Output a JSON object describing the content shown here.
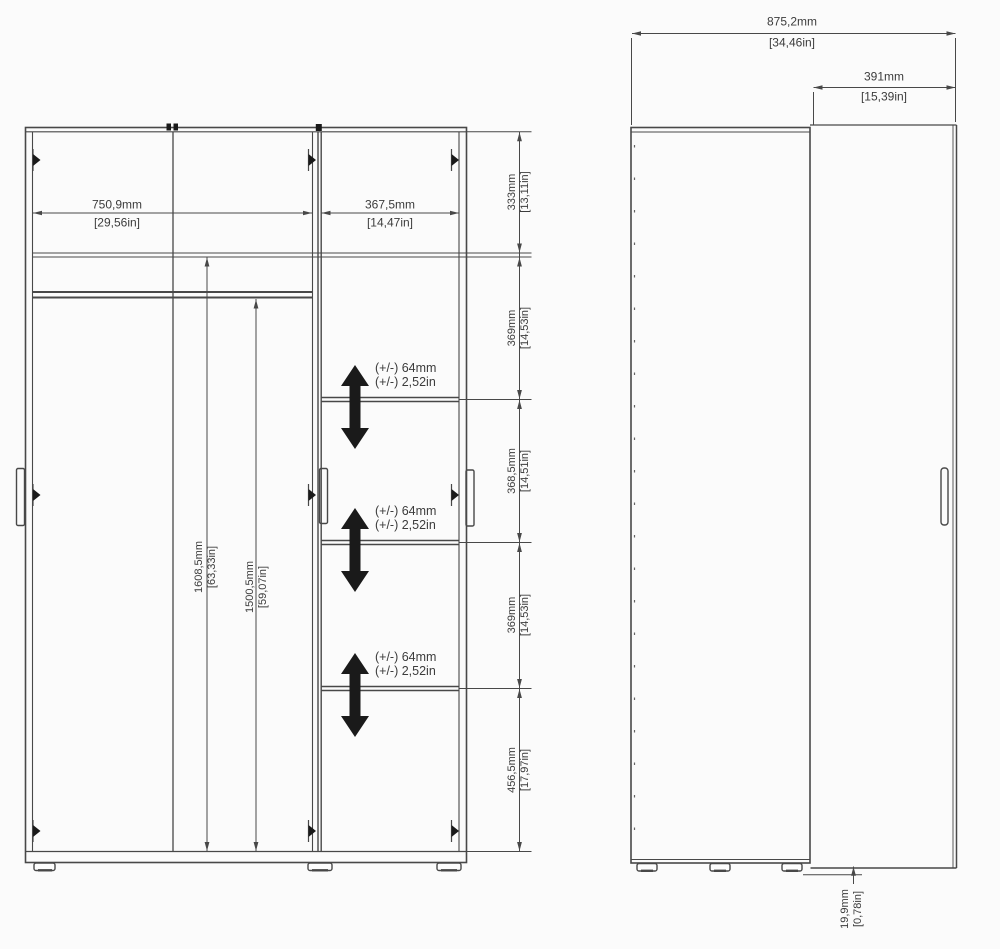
{
  "front_view": {
    "width_dims": [
      {
        "mm": "750,9mm",
        "inches": "[29,56in]"
      },
      {
        "mm": "367,5mm",
        "inches": "[14,47in]"
      }
    ],
    "interior_height_dims": [
      {
        "mm": "1608,5mm",
        "inches": "[63,33in]"
      },
      {
        "mm": "1500,5mm",
        "inches": "[59,07in]"
      }
    ],
    "section_height_dims": [
      {
        "mm": "333mm",
        "inches": "[13,11in]"
      },
      {
        "mm": "369mm",
        "inches": "[14,53in]"
      },
      {
        "mm": "368,5mm",
        "inches": "[14,51in]"
      },
      {
        "mm": "369mm",
        "inches": "[14,53in]"
      },
      {
        "mm": "456,5mm",
        "inches": "[17,97in]"
      }
    ],
    "adjustable_shelf_notes": [
      {
        "mm": "(+/-) 64mm",
        "inches": "(+/-) 2,52in"
      },
      {
        "mm": "(+/-) 64mm",
        "inches": "(+/-) 2,52in"
      },
      {
        "mm": "(+/-) 64mm",
        "inches": "(+/-) 2,52in"
      }
    ]
  },
  "side_view": {
    "total_depth_dim": {
      "mm": "875,2mm",
      "inches": "[34,46in]"
    },
    "door_clearance_dim": {
      "mm": "391mm",
      "inches": "[15,39in]"
    },
    "floor_gap_dim": {
      "mm": "19,9mm",
      "inches": "[0,78in]"
    }
  },
  "colors": {
    "line": "#484848",
    "marker": "#1a1a1a",
    "background": "#fbfbfb",
    "text": "#3c3c3c"
  }
}
